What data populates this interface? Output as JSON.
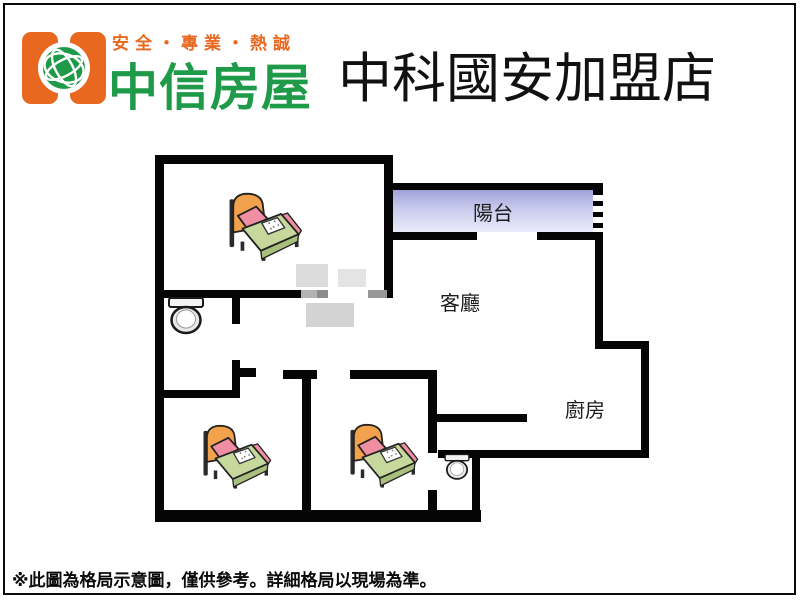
{
  "header": {
    "slogan": "安全・專業・熱誠",
    "brand": "中信房屋",
    "store_name": "中科國安加盟店",
    "colors": {
      "orange": "#E8681F",
      "green": "#1E9A48"
    }
  },
  "floorplan": {
    "labels": {
      "balcony": "陽台",
      "living_room": "客廳",
      "kitchen": "廚房"
    },
    "colors": {
      "wall": "#050505",
      "door_gray": "#9A9A9A",
      "balcony_top": "#9FA2D8",
      "balcony_bottom": "#EBECFA"
    },
    "icons": {
      "bed": "bed-icon",
      "toilet": "toilet-icon",
      "window": "window-hatch-icon"
    },
    "counts": {
      "beds": 3,
      "toilets": 2
    }
  },
  "footer": {
    "disclaimer": "※此圖為格局示意圖，僅供參考。詳細格局以現場為準。"
  }
}
